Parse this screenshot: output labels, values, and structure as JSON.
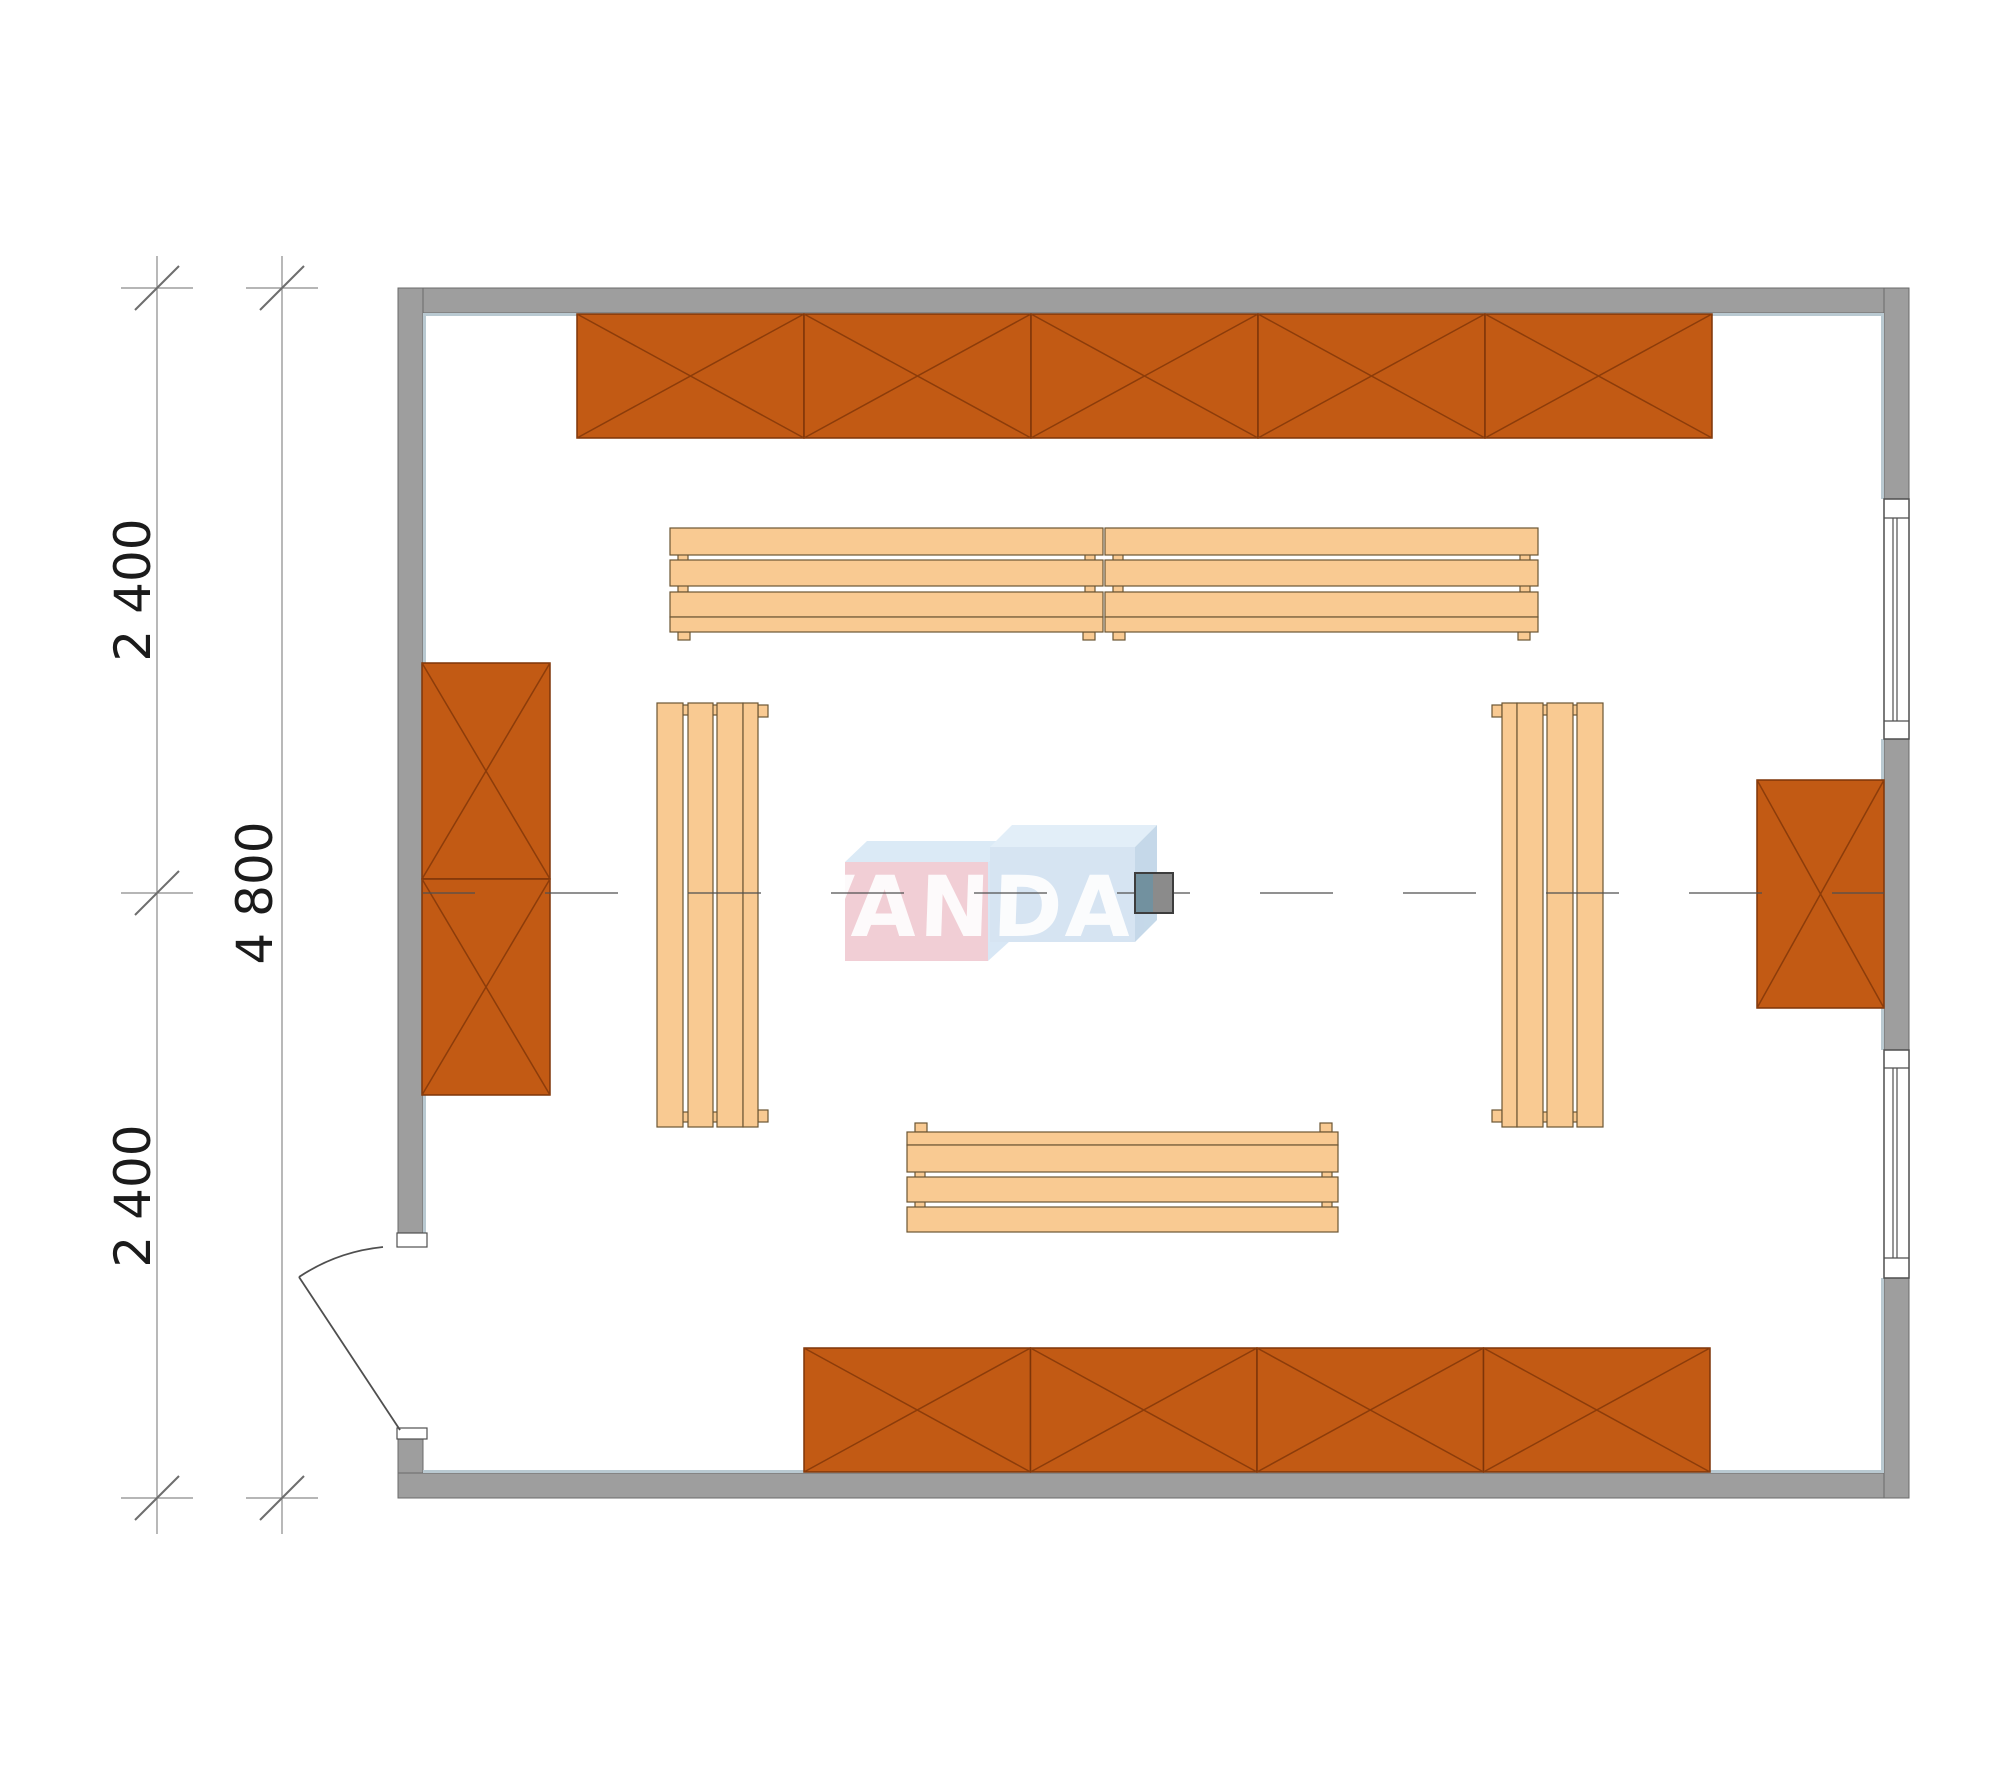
{
  "title": "Sauna room floor plan",
  "dimensions": {
    "segments": [
      "2 400",
      "2 400"
    ],
    "total": "4 800",
    "unit_note": "millimetres"
  },
  "watermark": {
    "text": "VANDA"
  },
  "plan": {
    "walls": {
      "shape": "rectangular room",
      "door_count": 1,
      "window_count": 2
    },
    "door": {
      "location": "bottom of left wall",
      "swing": "outward"
    },
    "windows": [
      {
        "location": "right wall upper"
      },
      {
        "location": "right wall lower"
      }
    ],
    "cabinets": [
      {
        "location": "top wall",
        "units": 5
      },
      {
        "location": "bottom wall",
        "units": 4
      },
      {
        "location": "left wall",
        "units": 2
      },
      {
        "location": "right wall",
        "units": 1
      }
    ],
    "benches": [
      {
        "location": "top",
        "sections": 2,
        "slats": 3
      },
      {
        "location": "left",
        "sections": 1,
        "slats": 3
      },
      {
        "location": "right",
        "sections": 1,
        "slats": 3
      },
      {
        "location": "bottom",
        "sections": 1,
        "slats": 3
      }
    ],
    "heater": {
      "location": "room centre on centreline",
      "count": 1
    }
  },
  "colors": {
    "wall": "#9e9e9e",
    "wall_outline": "#6b6b6b",
    "wall_inner_highlight": "#b9c9d1",
    "cabinet": "#c25a14",
    "cabinet_outline": "#7e3508",
    "bench": "#f9ca92",
    "bench_outline": "#6b5634",
    "heater_left": "#72919f",
    "heater_right": "#8b8b8b",
    "watermark_pink": "#eec3cb",
    "watermark_blue": "#ccdef0",
    "dimension_text": "#1b1b1b"
  }
}
